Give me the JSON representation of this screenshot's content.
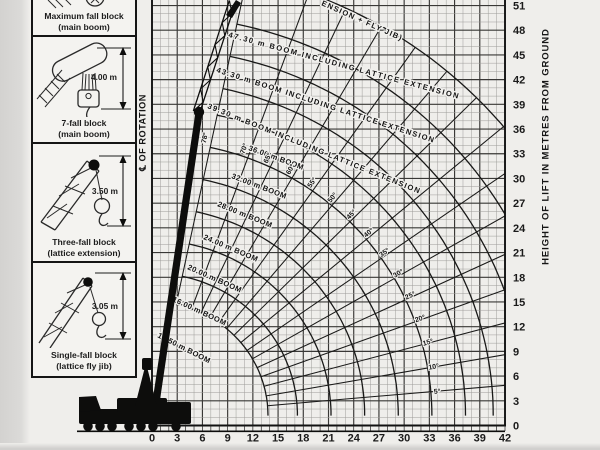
{
  "colors": {
    "paper": "#efeeeb",
    "ink": "#151515",
    "grid_minor": "#9d9c99",
    "grid_major": "#393836",
    "silhouette": "#0d0d0c"
  },
  "legend_blocks": [
    {
      "line1": "Maximum fall block",
      "line2": "(main boom)",
      "dimension": ""
    },
    {
      "line1": "7-fall block",
      "line2": "(main boom)",
      "dimension": "4.00 m"
    },
    {
      "line1": "Three-fall block",
      "line2": "(lattice extension)",
      "dimension": "3.50 m"
    },
    {
      "line1": "Single-fall block",
      "line2": "(lattice fly jib)",
      "dimension": "3.05 m"
    }
  ],
  "chart_data": {
    "type": "line",
    "subtype": "crane-working-range-fan",
    "rotation_axis_label": "℄ OF ROTATION",
    "x_axis": {
      "label": "RADIUS IN METRES FROM CENTRE OF ROTATION",
      "ticks": [
        "0",
        "3",
        "6",
        "9",
        "12",
        "15",
        "18",
        "21",
        "24",
        "27",
        "30",
        "33",
        "36",
        "39",
        "42"
      ],
      "tick_step_m": 3,
      "minor_step_m": 1,
      "max_m": 42
    },
    "y_axis": {
      "label": "HEIGHT OF LIFT IN METRES FROM GROUND",
      "ticks": [
        "0",
        "3",
        "6",
        "9",
        "12",
        "15",
        "18",
        "21",
        "24",
        "27",
        "30",
        "33",
        "36",
        "39",
        "42",
        "45",
        "48",
        "51"
      ],
      "tick_step_m": 3,
      "minor_step_m": 1,
      "max_m": 51.6
    },
    "pivot_height_m": 1.2,
    "hook_offset_m": 1.3,
    "max_boom_angle_deg": 78,
    "fan_inner_radius_m": 13.8,
    "fan_outer_radius_m": 54.6,
    "boom_angle_lines_deg": [
      5,
      10,
      15,
      20,
      25,
      30,
      35,
      40,
      45,
      50,
      55,
      60,
      65,
      70,
      78
    ],
    "boom_angle_labels_deg": [
      5,
      10,
      15,
      20,
      25,
      30,
      35,
      40,
      45,
      50,
      55,
      60,
      65,
      70,
      78
    ],
    "boom_curves": [
      {
        "length_m": 12.5,
        "label": "12.50 m BOOM",
        "lx": 157,
        "ly": 337,
        "rot": 27,
        "ls": 0.4
      },
      {
        "length_m": 16.0,
        "label": "16.00 m BOOM",
        "lx": 172,
        "ly": 301,
        "rot": 25,
        "ls": 0.4
      },
      {
        "length_m": 20.0,
        "label": "20.00 m BOOM",
        "lx": 187,
        "ly": 269,
        "rot": 24,
        "ls": 0.4
      },
      {
        "length_m": 24.0,
        "label": "24.00 m BOOM",
        "lx": 203,
        "ly": 239,
        "rot": 23,
        "ls": 0.4
      },
      {
        "length_m": 28.0,
        "label": "28.00 m BOOM",
        "lx": 217,
        "ly": 206,
        "rot": 22,
        "ls": 0.4
      },
      {
        "length_m": 32.0,
        "label": "32.00 m BOOM",
        "lx": 231,
        "ly": 178,
        "rot": 21,
        "ls": 0.4
      },
      {
        "length_m": 36.0,
        "label": "36.00 m BOOM",
        "lx": 248,
        "ly": 150,
        "rot": 20,
        "ls": 0.4
      },
      {
        "length_m": 39.3,
        "label": "39.30 m BOOM INCLUDING LATTICE EXTENSION",
        "lx": 207,
        "ly": 108,
        "rot": 22,
        "ls": 1.3
      },
      {
        "length_m": 43.3,
        "label": "43.30 m BOOM INCLUDING LATTICE EXTENSION",
        "lx": 216,
        "ly": 72,
        "rot": 18,
        "ls": 1.3
      },
      {
        "length_m": 47.3,
        "label": "47.30 m BOOM INCLUDING LATTICE EXTENSION",
        "lx": 228,
        "ly": 37,
        "rot": 15,
        "ls": 1.55
      },
      {
        "length_m": 53.3,
        "label": "ENSION + FLY JIB)",
        "lx": 321,
        "ly": 5,
        "rot": 24,
        "ls": 1.2
      }
    ]
  }
}
